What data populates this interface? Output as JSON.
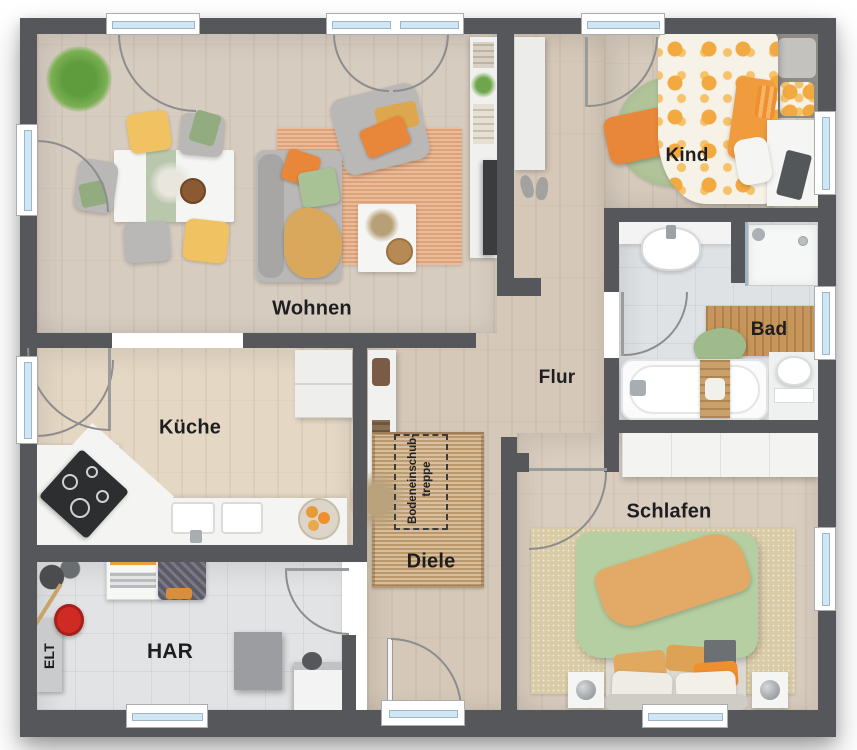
{
  "rooms": [
    {
      "id": "wohnen",
      "label": "Wohnen"
    },
    {
      "id": "kueche",
      "label": "Küche"
    },
    {
      "id": "flur",
      "label": "Flur"
    },
    {
      "id": "kind",
      "label": "Kind"
    },
    {
      "id": "bad",
      "label": "Bad"
    },
    {
      "id": "diele",
      "label": "Diele"
    },
    {
      "id": "schlafen",
      "label": "Schlafen"
    },
    {
      "id": "har",
      "label": "HAR"
    },
    {
      "id": "elt",
      "label": "ELT"
    }
  ],
  "annotations": {
    "attic_stairs_line1": "Bodeneinschub-",
    "attic_stairs_line2": "treppe"
  },
  "colors": {
    "wall": "#56575a",
    "window_glass": "#cfe6f4",
    "floor_wood": "#d7ccc0",
    "floor_kitchen": "#e4d7c4",
    "floor_tile": "#e1e3e4",
    "accent_orange": "#e8883a",
    "accent_green": "#a9c295",
    "accent_yellow": "#f0c261",
    "rug_terracotta": "#e5a97e",
    "rug_jute": "#c7a577",
    "duvet_green": "#b5cfa2",
    "mat_wood": "#c59559"
  }
}
